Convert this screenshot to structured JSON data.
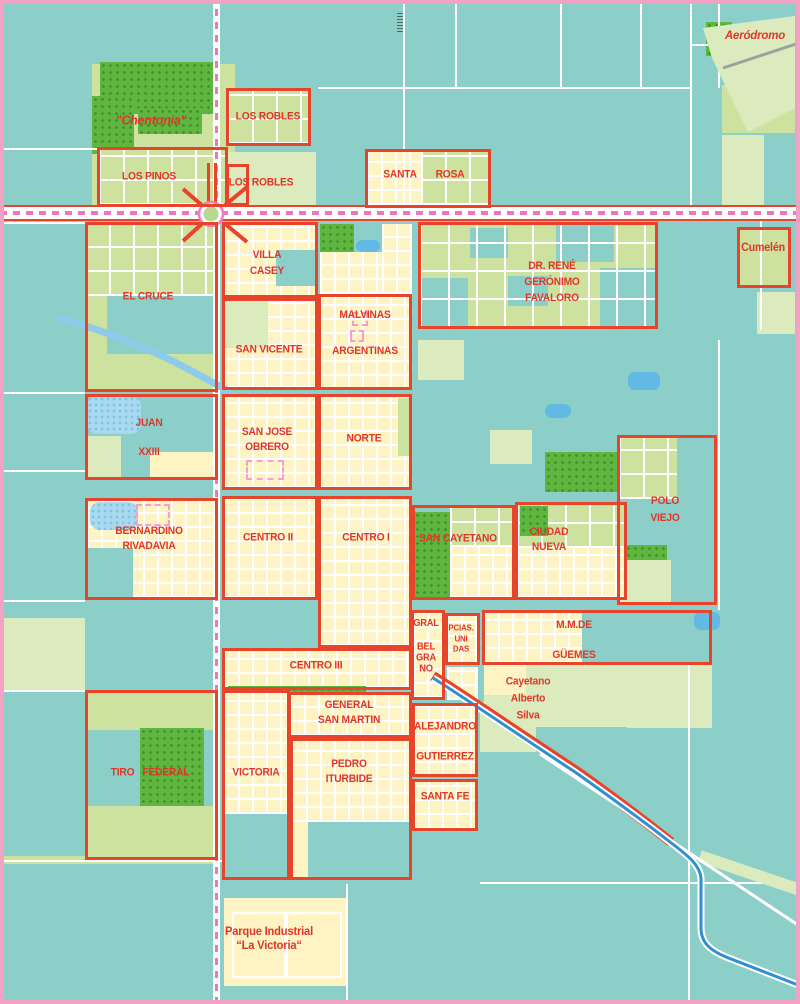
{
  "theme": {
    "teal": "#8ccfc9",
    "green": "#cde29f",
    "palegreen": "#dcebbd",
    "yellow": "#fdf3c3",
    "park": "#5eb53f",
    "parkdot": "#3f9427",
    "red": "#e8432b",
    "rail": "#f075be",
    "frame": "#f2a2c4",
    "water": "#a8d9ef",
    "pond": "#62b9e4",
    "stream": "#2f8fd0",
    "label": "#e0362a",
    "runway": "#98a2a0"
  },
  "map": {
    "labels": [
      {
        "id": "chentonia",
        "x": 151,
        "y": 121,
        "lines": [
          "\"Chentonia\""
        ],
        "size": 12.5,
        "italic": true
      },
      {
        "id": "los-robles-north",
        "x": 268,
        "y": 117,
        "lines": [
          "LOS ROBLES"
        ],
        "size": 11
      },
      {
        "id": "los-pinos",
        "x": 149,
        "y": 177,
        "lines": [
          "LOS PINOS"
        ],
        "size": 11
      },
      {
        "id": "los-robles-south",
        "x": 261,
        "y": 183,
        "lines": [
          "LOS ROBLES"
        ],
        "size": 11
      },
      {
        "id": "santa",
        "x": 400,
        "y": 175,
        "lines": [
          "SANTA"
        ],
        "size": 11
      },
      {
        "id": "rosa",
        "x": 450,
        "y": 175,
        "lines": [
          "ROSA"
        ],
        "size": 11
      },
      {
        "id": "aerodromo",
        "x": 755,
        "y": 37,
        "lines": [
          "Aeródromo"
        ],
        "size": 11.5,
        "italic": true
      },
      {
        "id": "cumelen",
        "x": 763,
        "y": 249,
        "lines": [
          "Cumelén"
        ],
        "size": 11.5
      },
      {
        "id": "el-cruce",
        "x": 148,
        "y": 297,
        "lines": [
          "EL CRUCE"
        ],
        "size": 11
      },
      {
        "id": "villa-casey",
        "x": 267,
        "y": 263,
        "lines": [
          "VILLA",
          "CASEY"
        ],
        "size": 11,
        "gap": 16
      },
      {
        "id": "san-vicente",
        "x": 269,
        "y": 350,
        "lines": [
          "SAN VICENTE"
        ],
        "size": 11
      },
      {
        "id": "malvinas-argentinas",
        "x": 365,
        "y": 333,
        "lines": [
          "MALVINAS",
          "ARGENTINAS"
        ],
        "size": 11,
        "gap": 36
      },
      {
        "id": "favaloro",
        "x": 552,
        "y": 282,
        "lines": [
          "DR. RENÉ",
          "GERÓNIMO",
          "FAVALORO"
        ],
        "size": 11,
        "gap": 16
      },
      {
        "id": "juan-xxiii",
        "x": 149,
        "y": 438,
        "lines": [
          "JUAN",
          "XXIII"
        ],
        "size": 11,
        "gap": 29
      },
      {
        "id": "san-jose-obrero",
        "x": 267,
        "y": 440,
        "lines": [
          "SAN JOSE",
          "OBRERO"
        ],
        "size": 11,
        "gap": 15
      },
      {
        "id": "norte",
        "x": 364,
        "y": 439,
        "lines": [
          "NORTE"
        ],
        "size": 11
      },
      {
        "id": "polo-viejo",
        "x": 665,
        "y": 510,
        "lines": [
          "POLO",
          "VIEJO"
        ],
        "size": 11,
        "gap": 17
      },
      {
        "id": "bernardino-rivadavia",
        "x": 149,
        "y": 539,
        "lines": [
          "BERNARDINO",
          "RIVADAVIA"
        ],
        "size": 11,
        "gap": 15
      },
      {
        "id": "centro-ii",
        "x": 268,
        "y": 538,
        "lines": [
          "CENTRO II"
        ],
        "size": 11
      },
      {
        "id": "centro-i",
        "x": 366,
        "y": 538,
        "lines": [
          "CENTRO I"
        ],
        "size": 11
      },
      {
        "id": "san-cayetano",
        "x": 458,
        "y": 539,
        "lines": [
          "SAN CAYETANO"
        ],
        "size": 11
      },
      {
        "id": "ciudad-nueva",
        "x": 549,
        "y": 540,
        "lines": [
          "CIUDAD",
          "NUEVA"
        ],
        "size": 11,
        "gap": 15
      },
      {
        "id": "gral",
        "x": 426,
        "y": 624,
        "lines": [
          "GRAL"
        ],
        "size": 10
      },
      {
        "id": "belgrano",
        "x": 426,
        "y": 658,
        "lines": [
          "BEL",
          "GRA",
          "NO"
        ],
        "size": 10,
        "gap": 11
      },
      {
        "id": "pcias-unidas",
        "x": 461,
        "y": 638,
        "lines": [
          "PCIAS.",
          "UNI",
          "DAS"
        ],
        "size": 8.5,
        "gap": 10.5
      },
      {
        "id": "mm-de-guemes",
        "x": 574,
        "y": 640,
        "lines": [
          "M.M.DE",
          "GÜEMES"
        ],
        "size": 11,
        "gap": 30
      },
      {
        "id": "centro-iii",
        "x": 316,
        "y": 666,
        "lines": [
          "CENTRO III"
        ],
        "size": 11
      },
      {
        "id": "cayetano-alberto-silva",
        "x": 528,
        "y": 699,
        "lines": [
          "Cayetano",
          "Alberto",
          "Silva"
        ],
        "size": 11,
        "gap": 17
      },
      {
        "id": "general-san-martin",
        "x": 349,
        "y": 713,
        "lines": [
          "GENERAL",
          "SAN MARTIN"
        ],
        "size": 11,
        "gap": 15
      },
      {
        "id": "alejandro",
        "x": 445,
        "y": 727,
        "lines": [
          "ALEJANDRO"
        ],
        "size": 11
      },
      {
        "id": "gutierrez",
        "x": 445,
        "y": 757,
        "lines": [
          "GUTIERREZ"
        ],
        "size": 11
      },
      {
        "id": "santa-fe",
        "x": 445,
        "y": 797,
        "lines": [
          "SANTA FE"
        ],
        "size": 11
      },
      {
        "id": "tiro-federal",
        "x": 150,
        "y": 773,
        "lines": [
          "TIRO   FEDERAL"
        ],
        "size": 11
      },
      {
        "id": "victoria",
        "x": 256,
        "y": 773,
        "lines": [
          "VICTORIA"
        ],
        "size": 11
      },
      {
        "id": "pedro-iturbide",
        "x": 349,
        "y": 772,
        "lines": [
          "PEDRO",
          "ITURBIDE"
        ],
        "size": 11,
        "gap": 15
      },
      {
        "id": "parque-industrial-la-victoria",
        "x": 269,
        "y": 938,
        "lines": [
          "Parque Industrial",
          "“La Victoria“"
        ],
        "size": 12,
        "gap": 14
      }
    ],
    "regions": [
      {
        "id": "los-robles-north",
        "x": 226,
        "y": 88,
        "w": 85,
        "h": 58
      },
      {
        "id": "los-pinos",
        "x": 97,
        "y": 147,
        "w": 131,
        "h": 60
      },
      {
        "id": "los-robles-south",
        "x": 226,
        "y": 164,
        "w": 23,
        "h": 42
      },
      {
        "id": "santa-rosa",
        "x": 365,
        "y": 149,
        "w": 126,
        "h": 59
      },
      {
        "id": "cumelen",
        "x": 737,
        "y": 227,
        "w": 54,
        "h": 61
      },
      {
        "id": "el-cruce",
        "x": 85,
        "y": 222,
        "w": 133,
        "h": 170
      },
      {
        "id": "villa-casey",
        "x": 222,
        "y": 222,
        "w": 96,
        "h": 76
      },
      {
        "id": "san-vicente",
        "x": 222,
        "y": 298,
        "w": 96,
        "h": 92
      },
      {
        "id": "malvinas-argentinas",
        "x": 318,
        "y": 294,
        "w": 94,
        "h": 96
      },
      {
        "id": "favaloro",
        "x": 418,
        "y": 222,
        "w": 240,
        "h": 107
      },
      {
        "id": "juan-xxiii",
        "x": 85,
        "y": 394,
        "w": 133,
        "h": 86
      },
      {
        "id": "san-jose-obrero",
        "x": 222,
        "y": 394,
        "w": 96,
        "h": 96
      },
      {
        "id": "norte",
        "x": 318,
        "y": 394,
        "w": 94,
        "h": 96
      },
      {
        "id": "polo-viejo",
        "x": 617,
        "y": 435,
        "w": 100,
        "h": 170
      },
      {
        "id": "bernardino-rivadavia",
        "x": 85,
        "y": 498,
        "w": 133,
        "h": 102
      },
      {
        "id": "centro-ii",
        "x": 222,
        "y": 496,
        "w": 96,
        "h": 104
      },
      {
        "id": "centro-i",
        "x": 318,
        "y": 496,
        "w": 94,
        "h": 152
      },
      {
        "id": "san-cayetano",
        "x": 412,
        "y": 505,
        "w": 103,
        "h": 95
      },
      {
        "id": "ciudad-nueva",
        "x": 515,
        "y": 502,
        "w": 112,
        "h": 98
      },
      {
        "id": "gral-belgrano",
        "x": 411,
        "y": 610,
        "w": 34,
        "h": 90
      },
      {
        "id": "pcias-unidas",
        "x": 445,
        "y": 613,
        "w": 35,
        "h": 52
      },
      {
        "id": "mm-de-guemes",
        "x": 482,
        "y": 610,
        "w": 230,
        "h": 55
      },
      {
        "id": "centro-iii",
        "x": 222,
        "y": 648,
        "w": 190,
        "h": 42
      },
      {
        "id": "general-san-martin",
        "x": 288,
        "y": 692,
        "w": 124,
        "h": 46
      },
      {
        "id": "alejandro-gutierrez",
        "x": 412,
        "y": 703,
        "w": 66,
        "h": 74
      },
      {
        "id": "santa-fe",
        "x": 412,
        "y": 779,
        "w": 66,
        "h": 52
      },
      {
        "id": "tiro-federal",
        "x": 85,
        "y": 690,
        "w": 133,
        "h": 170
      },
      {
        "id": "victoria",
        "x": 222,
        "y": 690,
        "w": 68,
        "h": 190
      },
      {
        "id": "pedro-iturbide",
        "x": 290,
        "y": 738,
        "w": 122,
        "h": 142
      }
    ]
  }
}
